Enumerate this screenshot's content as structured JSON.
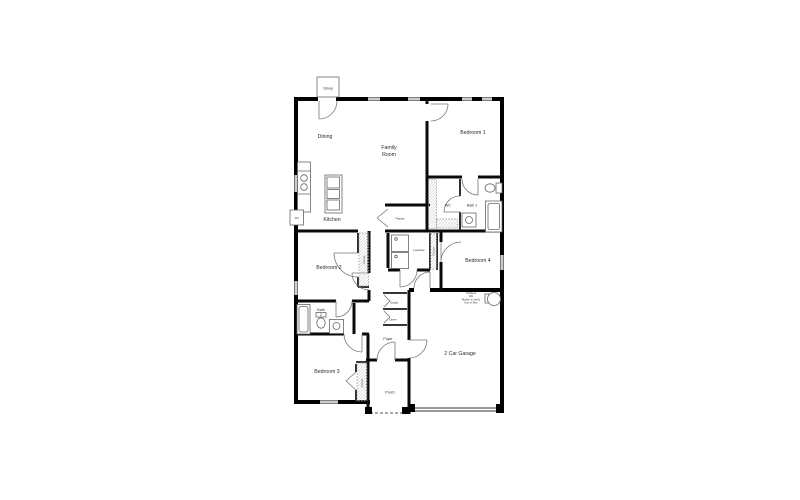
{
  "colors": {
    "wall": "#000000",
    "interior_wall": "#0a0a0a",
    "fixture_outline": "#666666",
    "door_arc": "#777777",
    "label_text": "#2b2b2b",
    "hatch": "#c9c9c9",
    "background": "#ffffff"
  },
  "rooms": {
    "stoop": "Stoop",
    "dining": "Dining",
    "family_room": {
      "line1": "Family",
      "line2": "Room"
    },
    "bedroom1": "Bedroom 1",
    "kitchen": "Kitchen",
    "ref": "Ref",
    "pantry": "Pantry",
    "wc": "WC",
    "bath1": "Bath 1",
    "laundry": "Laundry",
    "bedroom4": "Bedroom 4",
    "bedroom2": "Bedroom 2",
    "closet": "Closet",
    "bath2": {
      "line1": "Bath",
      "line2": "2"
    },
    "coats": "Coats",
    "linen": "Linen",
    "foyer": "Foyer",
    "bedroom3": "Bedroom 3",
    "porch": "Porch",
    "garage": "2 Car Garage",
    "water_heater_note": {
      "line1": "Tankless",
      "line2": "WH",
      "line3": "Builder to Verify",
      "line4": "Gas or Elec"
    }
  }
}
